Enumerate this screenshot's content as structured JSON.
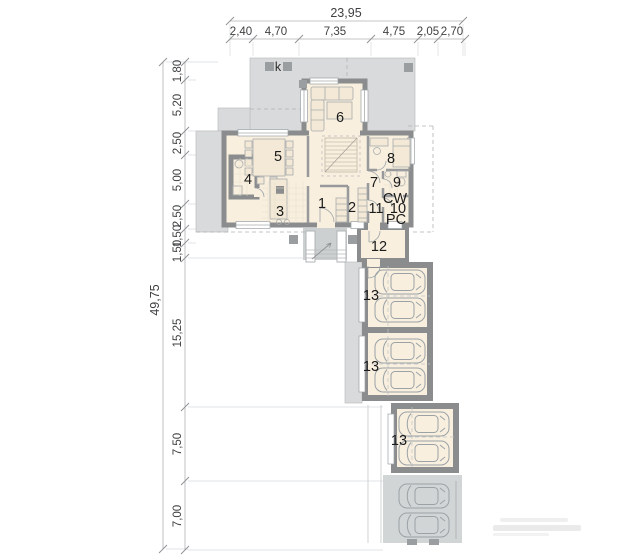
{
  "colors": {
    "wall": "#8a8c8d",
    "floor": "#f8efdf",
    "terrace": "#d8dadb",
    "terrace_dark": "#cdd0d1",
    "parking": "#d2d5d6",
    "column": "#9b9ea0",
    "dim_text": "#3f4142",
    "label_text": "#1b1b1b"
  },
  "dimensions": {
    "top": {
      "total": "23,95",
      "segments": [
        "2,40",
        "4,70",
        "7,35",
        "4,75",
        "2,05",
        "2,70"
      ]
    },
    "left": {
      "total": "49,75",
      "segments": [
        "1,80",
        "5,20",
        "2,50",
        "5,00",
        "2,50",
        "1,50",
        "1,50",
        "15,25",
        "7,50",
        "7,00"
      ]
    }
  },
  "plan": {
    "terrace_mark": "k",
    "rooms": {
      "r1": "1",
      "r2": "2",
      "r3": "3",
      "r4": "4",
      "r5": "5",
      "r6": "6",
      "r7": "7",
      "r8": "8",
      "r9": "9",
      "r10": "10",
      "r11": "11",
      "r12": "12"
    },
    "garages": [
      "13",
      "13",
      "13"
    ],
    "utility_labels": {
      "cw": "CW",
      "pc": "PC"
    }
  }
}
